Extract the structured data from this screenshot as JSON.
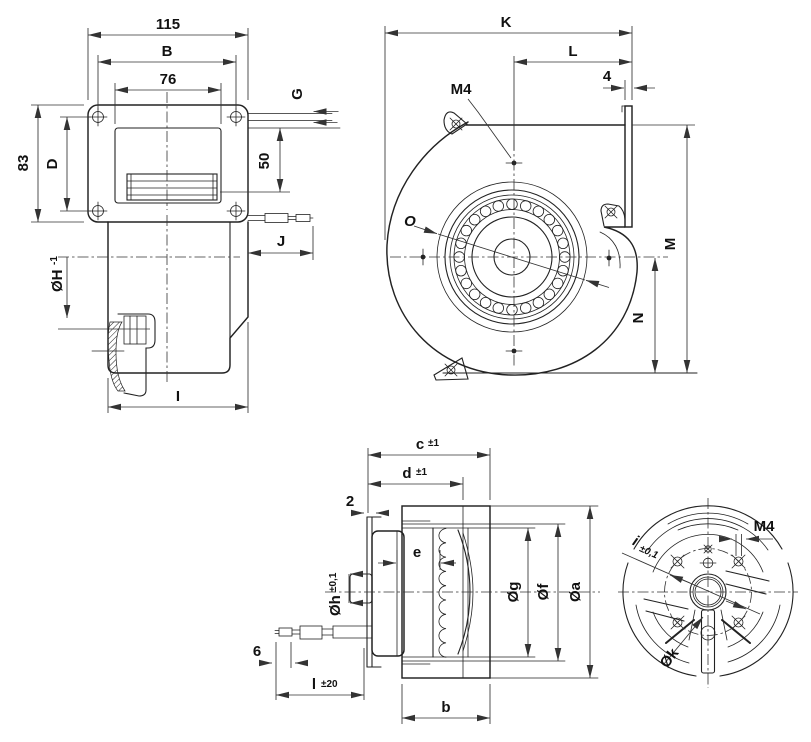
{
  "title": "Centrifugal blower dimension drawing",
  "colors": {
    "background": "#ffffff",
    "line": "#222222",
    "dimension_line": "#333333",
    "text": "#111111"
  },
  "views": {
    "side_flange": {
      "d115": "115",
      "dB": "B",
      "d76": "76",
      "d83": "83",
      "dD": "D",
      "dG": "G",
      "d50": "50",
      "dOH": "ØH",
      "dOH_tol": "-1",
      "dJ": "J",
      "dI": "I"
    },
    "front_scroll": {
      "dK": "K",
      "dL": "L",
      "d4": "4",
      "dM4": "M4",
      "dO": "O",
      "dM": "M",
      "dN": "N"
    },
    "side_motor": {
      "dc": "c",
      "dc_tol": "±1",
      "dd": "d",
      "dd_tol": "±1",
      "d2": "2",
      "de": "e",
      "dOh": "Øh",
      "dOh_tol": "±0,1",
      "d6": "6",
      "dl": "l",
      "dl_tol": "±20",
      "dOg": "Øg",
      "dOf": "Øf",
      "dOa": "Øa",
      "db": "b"
    },
    "rear_motor": {
      "dM4": "M4",
      "di": "i",
      "di_tol": "±0,1",
      "dOk": "Øk"
    }
  }
}
